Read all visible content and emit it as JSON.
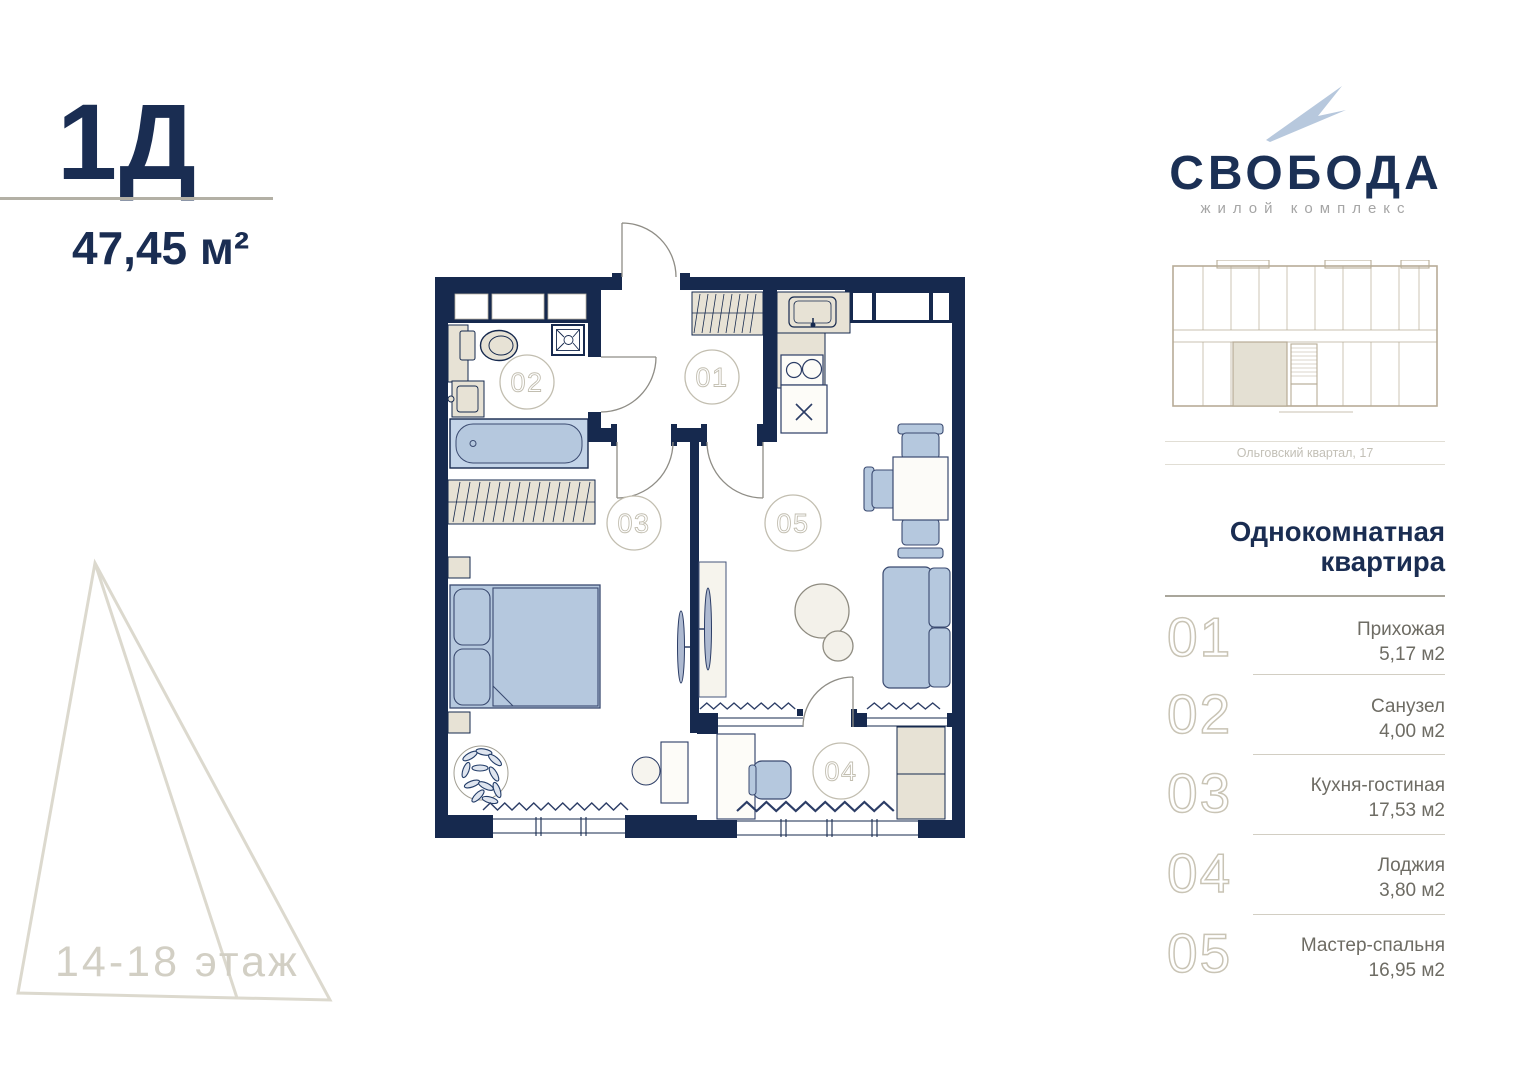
{
  "header": {
    "unit_code": "1Д",
    "area": "47,45 м²"
  },
  "floor_label": "14-18 этаж",
  "logo": {
    "name": "СВОБОДА",
    "subtitle": "жилой комплекс"
  },
  "building": {
    "caption": "Ольговский квартал, 17"
  },
  "apartment": {
    "type_line1": "Однокомнатная",
    "type_line2": "квартира"
  },
  "rooms": [
    {
      "num": "01",
      "name": "Прихожая",
      "area": "5,17 м2"
    },
    {
      "num": "02",
      "name": "Санузел",
      "area": "4,00 м2"
    },
    {
      "num": "03",
      "name": "Кухня-гостиная",
      "area": "17,53 м2"
    },
    {
      "num": "04",
      "name": "Лоджия",
      "area": "3,80 м2"
    },
    {
      "num": "05",
      "name": "Мастер-спальня",
      "area": "16,95 м2"
    }
  ],
  "colors": {
    "navy": "#16294e",
    "furniture_blue": "#b5c8de",
    "furniture_beige": "#e7e2d5",
    "plan_tan": "#b7ac97",
    "label_gray": "#c2beb0"
  }
}
